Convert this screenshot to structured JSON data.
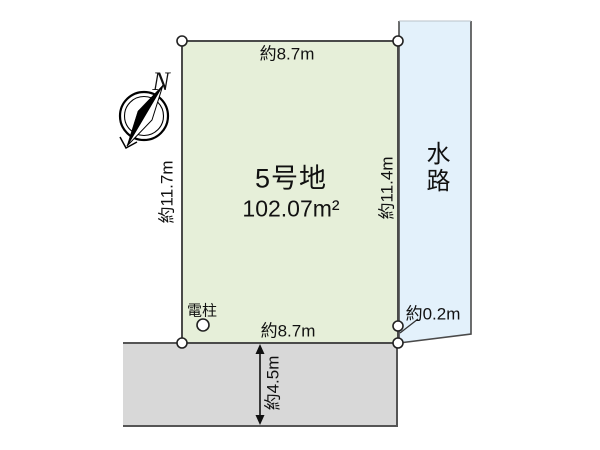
{
  "plot": {
    "name": "5号地",
    "area": "102.07m²"
  },
  "dimensions": {
    "top": "約8.7m",
    "left": "約11.7m",
    "right": "約11.4m",
    "bottom": "約8.7m",
    "waterway_offset": "約0.2m",
    "road_width": "約4.5m"
  },
  "labels": {
    "waterway": "水路",
    "utility_pole": "電柱",
    "compass_north": "N"
  },
  "colors": {
    "plot_fill": "#e6efd9",
    "waterway_fill": "#e3f1fb",
    "road_fill": "#d8d8d8",
    "line": "#4a4a4a"
  }
}
